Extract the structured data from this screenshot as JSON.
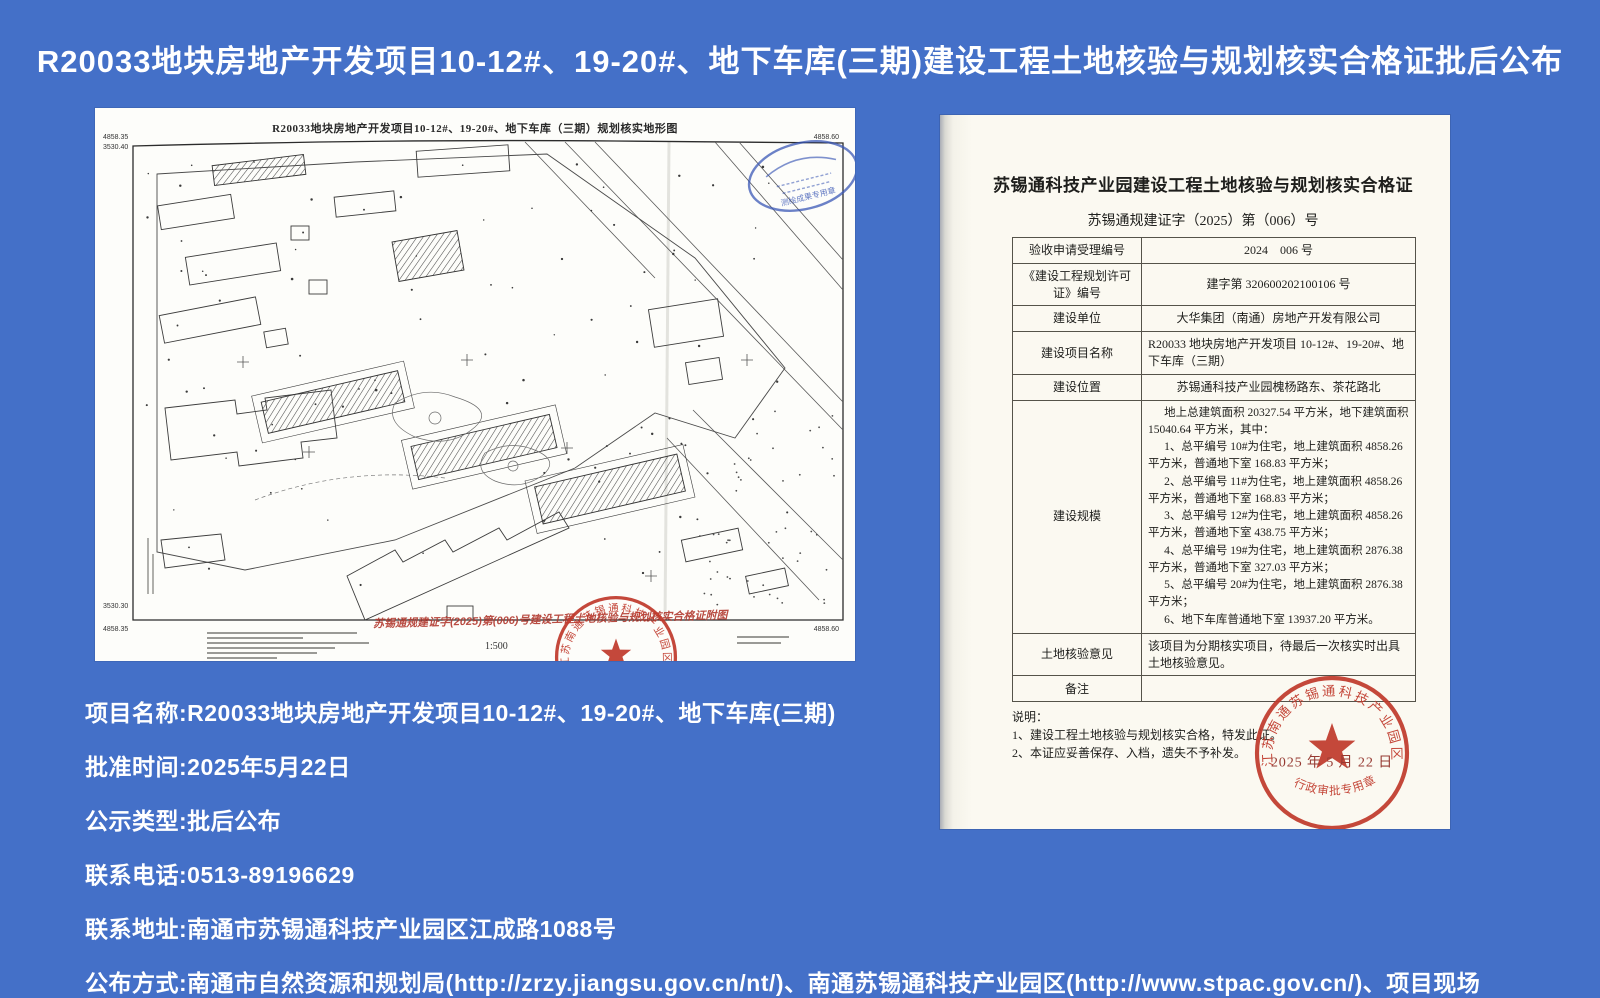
{
  "page": {
    "title": "R20033地块房地产开发项目10-12#、19-20#、地下车库(三期)建设工程土地核验与规划核实合格证批后公布"
  },
  "info": {
    "lines": [
      "项目名称:R20033地块房地产开发项目10-12#、19-20#、地下车库(三期)",
      "批准时间:2025年5月22日",
      "公示类型:批后公布",
      "联系电话:0513-89196629",
      "联系地址:南通市苏锡通科技产业园区江成路1088号",
      "公布方式:南通市自然资源和规划局(http://zrzy.jiangsu.gov.cn/nt/)、南通苏锡通科技产业园区(http://www.stpac.gov.cn/)、项目现场"
    ]
  },
  "map_doc": {
    "title": "R20033地块房地产开发项目10-12#、19-20#、地下车库（三期）规划核实地形图",
    "scale": "1:500",
    "red_note": "苏锡通规建证字(2025)第(006)号建设工程土地核验与规划核实合格证附图",
    "coords": {
      "tl_e": "4858.35",
      "tl_n": "3530.40",
      "tr": "4858.60",
      "bl_n": "3530.30",
      "bl": "4858.35",
      "br": "4858.60"
    },
    "surveyor_seal_text": "测绘成果专用章"
  },
  "certificate": {
    "title": "苏锡通科技产业园建设工程土地核验与规划核实合格证",
    "number": "苏锡通规建证字（2025）第（006）号",
    "rows": [
      {
        "label": "验收申请受理编号",
        "value": "2024　006 号"
      },
      {
        "label": "《建设工程规划许可证》编号",
        "value": "建字第 320600202100106 号"
      },
      {
        "label": "建设单位",
        "value": "大华集团（南通）房地产开发有限公司"
      },
      {
        "label": "建设项目名称",
        "value": "R20033 地块房地产开发项目 10-12#、19-20#、地下车库（三期）"
      },
      {
        "label": "建设位置",
        "value": "苏锡通科技产业园槐杨路东、茶花路北"
      },
      {
        "label": "建设规模"
      },
      {
        "label": "土地核验意见",
        "value": "该项目为分期核实项目，待最后一次核实时出具土地核验意见。"
      },
      {
        "label": "备注",
        "value": ""
      }
    ],
    "scale_lines": [
      "地上总建筑面积 20327.54 平方米，地下建筑面积 15040.64 平方米，其中：",
      "1、总平编号 10#为住宅，地上建筑面积 4858.26 平方米，普通地下室 168.83 平方米；",
      "2、总平编号 11#为住宅，地上建筑面积 4858.26 平方米，普通地下室 168.83 平方米；",
      "3、总平编号 12#为住宅，地上建筑面积 4858.26 平方米，普通地下室 438.75 平方米；",
      "4、总平编号 19#为住宅，地上建筑面积 2876.38 平方米，普通地下室 327.03 平方米；",
      "5、总平编号 20#为住宅，地上建筑面积 2876.38 平方米；",
      "6、地下车库普通地下室 13937.20 平方米。"
    ],
    "notes_title": "说明：",
    "notes": [
      "1、建设工程土地核验与规划核实合格，特发此证。",
      "2、本证应妥善保存、入档，遗失不予补发。"
    ],
    "stamp": {
      "ring_text": "江苏南通苏锡通科技产业园区管理委员会",
      "bottom_text": "行政审批专用章",
      "date": "2025 年 5 月 22 日"
    }
  }
}
